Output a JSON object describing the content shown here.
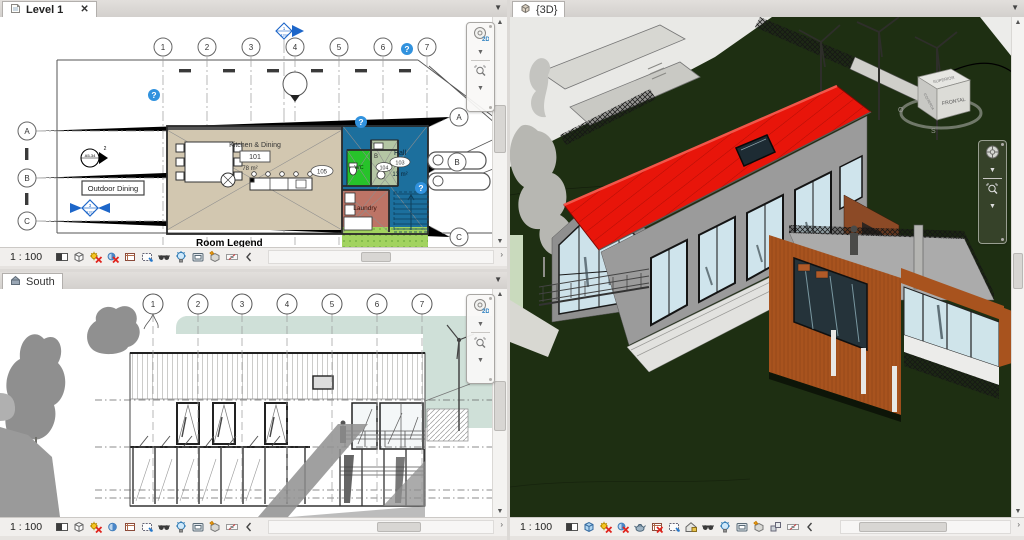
{
  "tabs": {
    "level1": {
      "label": "Level 1",
      "close": "✕"
    },
    "south": {
      "label": "South"
    },
    "threeD": {
      "label": "{3D}"
    }
  },
  "view_control": {
    "scale": "1 : 100",
    "plan_icons": [
      "detail-level",
      "visual-style",
      "sun-path-off",
      "shadows-off",
      "crop-view",
      "crop-region",
      "hide-isolate-glasses",
      "reveal-hidden-bulb",
      "temp-view-properties",
      "highlight-displacement",
      "reveal-constraints",
      "collapse-chevron"
    ],
    "elevation_icons": [
      "detail-level",
      "visual-style",
      "sun-path-off",
      "shadows-on",
      "crop-view",
      "crop-region",
      "hide-isolate-glasses",
      "reveal-hidden-bulb",
      "temp-view-properties",
      "highlight-displacement",
      "reveal-constraints",
      "collapse-chevron"
    ],
    "threed_icons": [
      "detail-level",
      "visual-style-3d",
      "sun-path-off",
      "shadows-off",
      "rendering",
      "crop-view-off",
      "crop-region",
      "unlocked-3d",
      "hide-isolate-glasses",
      "reveal-hidden-bulb",
      "temp-view-properties",
      "highlight-displacement",
      "displace-elements",
      "reveal-constraints",
      "collapse-chevron"
    ]
  },
  "plan": {
    "grid_cols": [
      "1",
      "2",
      "3",
      "4",
      "5",
      "6",
      "7"
    ],
    "grid_rows_left": [
      "A",
      "B",
      "C"
    ],
    "grid_rows_right": [
      "A",
      "B",
      "C"
    ],
    "rooms": {
      "kitchen": {
        "name": "Kitchen & Dining",
        "tag": "101",
        "area": "78 m²"
      },
      "hall": {
        "name": "Hall",
        "tag": "103",
        "area": "13 m²"
      },
      "wc": {
        "name": "WC"
      },
      "bath": {
        "label": "B",
        "tag": "104"
      },
      "laundry": {
        "name": "Laundry"
      },
      "door_tag": "105"
    },
    "annotations": {
      "outdoor_dining": "Outdoor Dining",
      "room_legend": "Room Legend",
      "section_marker": "A5-34",
      "section_ref": "2",
      "callout_num": "3",
      "callout_sheet": "A102",
      "elev_num": "1",
      "elev_sheet": "A104",
      "question_badge": "?"
    }
  },
  "south": {
    "grid_cols": [
      "1",
      "2",
      "3",
      "4",
      "5",
      "6",
      "7"
    ]
  },
  "three_d": {
    "viewcube": {
      "top": "SUPERIOR",
      "front": "FRONTAL",
      "side": "IZQUIERDA",
      "compass_west": "O",
      "compass_south": "S"
    }
  },
  "colors": {
    "hall_blue": "#1c6f9d",
    "wc_green": "#27c32a",
    "laundry_red": "#bd7466",
    "kitchen_floor": "#d2c7b0",
    "grass": "#a2d35f",
    "sky_band": "#cfe0d8",
    "roof_red": "#e8150a",
    "annex_orange": "#a8531e",
    "ground_green": "#1e2f12"
  }
}
